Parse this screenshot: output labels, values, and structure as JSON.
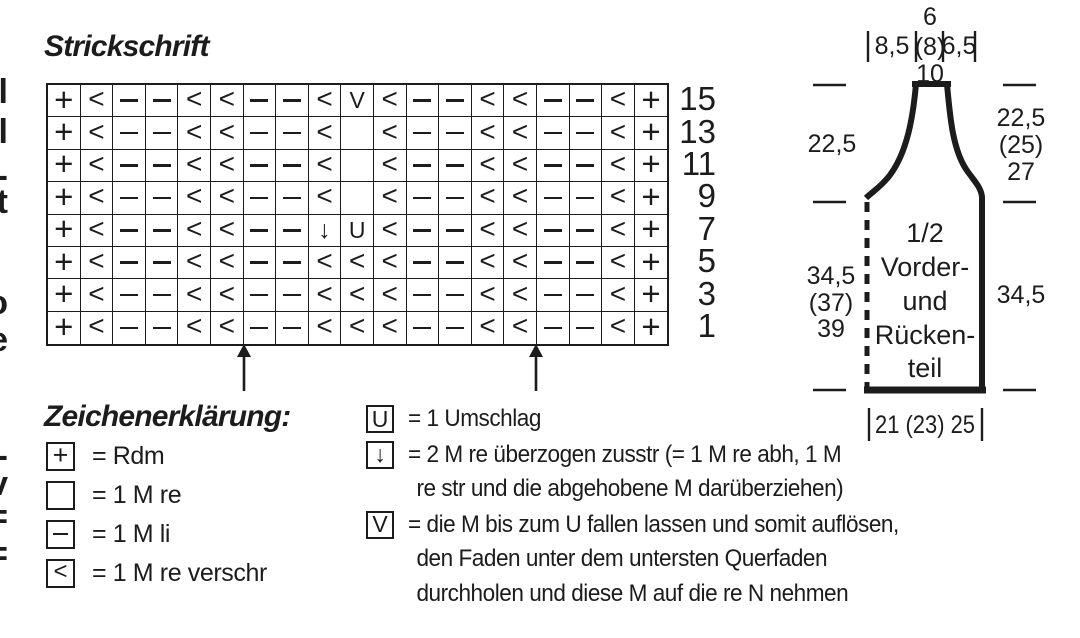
{
  "chart": {
    "title": "Strickschrift",
    "row_numbers": [
      "15",
      "13",
      "11",
      "9",
      "7",
      "5",
      "3",
      "1"
    ],
    "rows": [
      [
        "+",
        "<",
        "-",
        "-",
        "<",
        "<",
        "-",
        "-",
        "<",
        "V",
        "<",
        "-",
        "-",
        "<",
        "<",
        "-",
        "-",
        "<",
        "+"
      ],
      [
        "+",
        "<",
        "-",
        "-",
        "<",
        "<",
        "-",
        "-",
        "<",
        "",
        "<",
        "-",
        "-",
        "<",
        "<",
        "-",
        "-",
        "<",
        "+"
      ],
      [
        "+",
        "<",
        "-",
        "-",
        "<",
        "<",
        "-",
        "-",
        "<",
        "",
        "<",
        "-",
        "-",
        "<",
        "<",
        "-",
        "-",
        "<",
        "+"
      ],
      [
        "+",
        "<",
        "-",
        "-",
        "<",
        "<",
        "-",
        "-",
        "<",
        "",
        "<",
        "-",
        "-",
        "<",
        "<",
        "-",
        "-",
        "<",
        "+"
      ],
      [
        "+",
        "<",
        "-",
        "-",
        "<",
        "<",
        "-",
        "-",
        "↓",
        "U",
        "<",
        "-",
        "-",
        "<",
        "<",
        "-",
        "-",
        "<",
        "+"
      ],
      [
        "+",
        "<",
        "-",
        "-",
        "<",
        "<",
        "-",
        "-",
        "<",
        "<",
        "<",
        "-",
        "-",
        "<",
        "<",
        "-",
        "-",
        "<",
        "+"
      ],
      [
        "+",
        "<",
        "-",
        "-",
        "<",
        "<",
        "-",
        "-",
        "<",
        "<",
        "<",
        "-",
        "-",
        "<",
        "<",
        "-",
        "-",
        "<",
        "+"
      ],
      [
        "+",
        "<",
        "-",
        "-",
        "<",
        "<",
        "-",
        "-",
        "<",
        "<",
        "<",
        "-",
        "-",
        "<",
        "<",
        "-",
        "-",
        "<",
        "+"
      ]
    ]
  },
  "legend": {
    "heading": "Zeichenerklärung:",
    "left_items": [
      {
        "symbol": "+",
        "text": "= Rdm"
      },
      {
        "symbol": "",
        "text": "= 1 M re"
      },
      {
        "symbol": "-",
        "text": "= 1 M li"
      },
      {
        "symbol": "<",
        "text": "= 1 M re verschr"
      }
    ],
    "right_items": [
      {
        "symbol": "U",
        "lines": [
          "= 1 Umschlag"
        ]
      },
      {
        "symbol": "↓",
        "lines": [
          "= 2 M re überzogen zusstr (= 1 M re abh, 1 M",
          "re str und die abgehobene M darüberziehen)"
        ]
      },
      {
        "symbol": "V",
        "lines": [
          "= die M bis zum U fallen lassen und somit auflösen,",
          "den Faden unter dem untersten Querfaden",
          "durchholen und diese M auf die re N nehmen"
        ]
      }
    ]
  },
  "schematic": {
    "label_lines": [
      "1/2",
      "Vorder-",
      "und",
      "Rücken-",
      "teil"
    ],
    "top_measures": {
      "left": "8,5",
      "above": "6",
      "middle": "(8)",
      "below": "10",
      "right": "6,5"
    },
    "sides": {
      "left_upper": "22,5",
      "left_lower": [
        "34,5",
        "(37)",
        "39"
      ],
      "right_upper": [
        "22,5",
        "(25)",
        "27"
      ],
      "right_lower": "34,5"
    },
    "bottom_measure": "21 (23) 25"
  },
  "margin_fragments": [
    {
      "glyph": "l",
      "top": 72
    },
    {
      "glyph": "l",
      "top": 112
    },
    {
      "glyph": "-",
      "top": 156
    },
    {
      "glyph": "t",
      "top": 182
    },
    {
      "glyph": "o",
      "top": 283
    },
    {
      "glyph": "e",
      "top": 320
    },
    {
      "glyph": "-",
      "top": 436
    },
    {
      "glyph": "v",
      "top": 464
    },
    {
      "glyph": "=",
      "top": 497
    },
    {
      "glyph": "=",
      "top": 534
    }
  ]
}
